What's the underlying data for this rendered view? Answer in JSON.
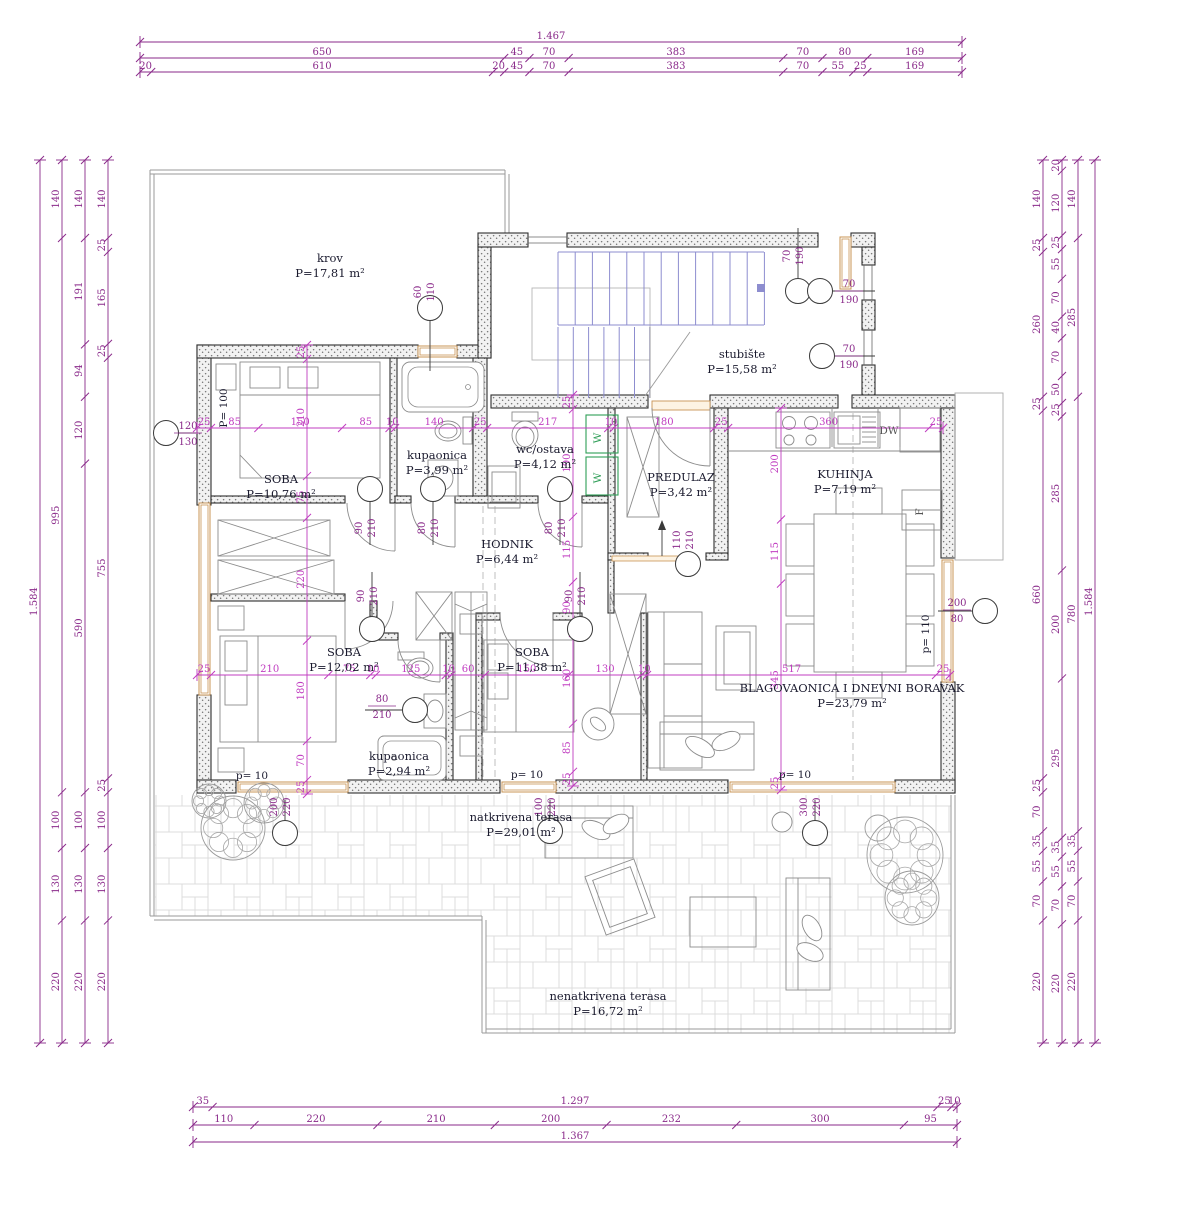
{
  "colors": {
    "dim": "#8a2a8a",
    "centerline": "#c03cc0",
    "wall_edge": "#2e2e2e",
    "marker_line": "#3a3a3a",
    "furniture": "#8c8c8c",
    "stairs": "#8d8dcf",
    "window_frame": "#c89455",
    "appliance_green": "#2f9e57",
    "room_text": "#1a1a2e",
    "outline": "#9a9a9a"
  },
  "rooms": [
    {
      "name": "krov",
      "area": "P=17,81 m²",
      "x": 330,
      "y": 262
    },
    {
      "name": "stubište",
      "area": "P=15,58 m²",
      "x": 742,
      "y": 358
    },
    {
      "name": "kupaonica",
      "area": "P=3,99 m²",
      "x": 437,
      "y": 459
    },
    {
      "name": "wc/ostava",
      "area": "P=4,12 m²",
      "x": 545,
      "y": 453
    },
    {
      "name": "PREDULAZ",
      "area": "P=3,42 m²",
      "x": 681,
      "y": 481
    },
    {
      "name": "KUHINJA",
      "area": "P=7,19 m²",
      "x": 845,
      "y": 478
    },
    {
      "name": "SOBA",
      "area": "P=10,76 m²",
      "x": 281,
      "y": 483
    },
    {
      "name": "HODNIK",
      "area": "P=6,44 m²",
      "x": 507,
      "y": 548
    },
    {
      "name": "SOBA",
      "area": "P=12,02 m²",
      "x": 344,
      "y": 656
    },
    {
      "name": "SOBA",
      "area": "P=11,38 m²",
      "x": 532,
      "y": 656
    },
    {
      "name": "BLAGOVAONICA I DNEVNI BORAVAK",
      "area": "P=23,79 m²",
      "x": 852,
      "y": 692
    },
    {
      "name": "kupaonica",
      "area": "P=2,94 m²",
      "x": 399,
      "y": 760
    },
    {
      "name": "natkrivena terasa",
      "area": "P=29,01 m²",
      "x": 521,
      "y": 821
    },
    {
      "name": "nenatkrivena terasa",
      "area": "P=16,72 m²",
      "x": 608,
      "y": 1000
    }
  ],
  "dim_chains": [
    {
      "id": "top-total",
      "orient": "h",
      "pos": 42,
      "from": 140,
      "to": 962,
      "values": [
        "1.467"
      ]
    },
    {
      "id": "top-2",
      "orient": "h",
      "pos": 58,
      "from": 140,
      "to": 962,
      "values": [
        "650",
        "45",
        "70",
        "383",
        "70",
        "80",
        "169"
      ]
    },
    {
      "id": "top-3",
      "orient": "h",
      "pos": 72,
      "from": 140,
      "to": 962,
      "values": [
        "20",
        "610",
        "20",
        "45",
        "70",
        "383",
        "70",
        "55",
        "25",
        "169"
      ]
    },
    {
      "id": "bottom-1",
      "orient": "h",
      "pos": 1107,
      "from": 193,
      "to": 957,
      "values": [
        "35",
        "1.297",
        "25",
        "10"
      ]
    },
    {
      "id": "bottom-2",
      "orient": "h",
      "pos": 1125,
      "from": 193,
      "to": 957,
      "values": [
        "110",
        "220",
        "210",
        "200",
        "232",
        "300",
        "95"
      ]
    },
    {
      "id": "bottom-total",
      "orient": "h",
      "pos": 1142,
      "from": 193,
      "to": 957,
      "values": [
        "1.367"
      ]
    },
    {
      "id": "left-total",
      "orient": "v",
      "pos": 40,
      "from": 160,
      "to": 1043,
      "values": [
        "1.584"
      ]
    },
    {
      "id": "left-2",
      "orient": "v",
      "pos": 62,
      "from": 160,
      "to": 1043,
      "values": [
        "140",
        "995",
        "100",
        "130",
        "220"
      ]
    },
    {
      "id": "left-3",
      "orient": "v",
      "pos": 85,
      "from": 160,
      "to": 1043,
      "values": [
        "140",
        "191",
        "94",
        "120",
        "590",
        "100",
        "130",
        "220"
      ]
    },
    {
      "id": "left-4",
      "orient": "v",
      "pos": 108,
      "from": 160,
      "to": 1043,
      "values": [
        "140",
        "25",
        "165",
        "25",
        "755",
        "25",
        "100",
        "130",
        "220"
      ]
    },
    {
      "id": "right-1",
      "orient": "v",
      "pos": 1043,
      "from": 160,
      "to": 1043,
      "values": [
        "140",
        "25",
        "260",
        "25",
        "660",
        "25",
        "70",
        "35",
        "55",
        "70",
        "220"
      ]
    },
    {
      "id": "right-2",
      "orient": "v",
      "pos": 1062,
      "from": 160,
      "to": 1043,
      "values": [
        "20",
        "120",
        "25",
        "55",
        "70",
        "40",
        "70",
        "50",
        "25",
        "285",
        "200",
        "295",
        "35",
        "55",
        "70",
        "220"
      ]
    },
    {
      "id": "right-3",
      "orient": "v",
      "pos": 1078,
      "from": 160,
      "to": 1043,
      "values": [
        "140",
        "285",
        "780",
        "35",
        "55",
        "70",
        "220"
      ]
    },
    {
      "id": "right-total",
      "orient": "v",
      "pos": 1095,
      "from": 160,
      "to": 1043,
      "values": [
        "1.584"
      ]
    },
    {
      "id": "int-h1",
      "orient": "h",
      "pos": 428,
      "from": 197,
      "to": 943,
      "color": "centerline",
      "values": [
        "25",
        "85",
        "150",
        "85",
        "10",
        "140",
        "25",
        "217",
        "10",
        "180",
        "25",
        "360",
        "25"
      ]
    },
    {
      "id": "int-h2",
      "orient": "h",
      "pos": 675,
      "from": 197,
      "to": 950,
      "color": "centerline",
      "values": [
        "25",
        "210",
        "75",
        "10",
        "125",
        "10",
        "60",
        "150",
        "130",
        "10",
        "517",
        "25"
      ]
    },
    {
      "id": "int-v1",
      "orient": "v",
      "pos": 307,
      "from": 345,
      "to": 794,
      "color": "centerline",
      "values": [
        "25",
        "210",
        "75",
        "220",
        "180",
        "70",
        "25"
      ]
    },
    {
      "id": "int-v2",
      "orient": "v",
      "pos": 573,
      "from": 395,
      "to": 786,
      "color": "centerline",
      "values": [
        "25",
        "190",
        "115",
        "90",
        "160",
        "85",
        "25"
      ]
    },
    {
      "id": "int-v3",
      "orient": "v",
      "pos": 781,
      "from": 408,
      "to": 790,
      "color": "centerline",
      "values": [
        "200",
        "115",
        "345",
        "25"
      ]
    }
  ],
  "markers": [
    {
      "name": "krov-window",
      "mode": "rot",
      "labels": [
        "60",
        "110"
      ],
      "circle": [
        430,
        308
      ],
      "line": [
        430,
        321,
        430,
        371
      ],
      "lx": 421,
      "ly": 292
    },
    {
      "name": "left-window",
      "mode": "frac",
      "labels": [
        "120",
        "130"
      ],
      "circle": [
        166,
        433
      ],
      "line": [
        179,
        433,
        196,
        433
      ],
      "lx": 188,
      "ly": 429
    },
    {
      "name": "door-soba1",
      "mode": "rot",
      "labels": [
        "90",
        "210"
      ],
      "circle": [
        370,
        489
      ],
      "line": [
        370,
        502,
        370,
        545
      ],
      "lx": 362,
      "ly": 528
    },
    {
      "name": "door-kupaonica",
      "mode": "rot",
      "labels": [
        "80",
        "210"
      ],
      "circle": [
        433,
        489
      ],
      "line": [
        433,
        502,
        433,
        545
      ],
      "lx": 425,
      "ly": 528
    },
    {
      "name": "door-wc",
      "mode": "rot",
      "labels": [
        "80",
        "210"
      ],
      "circle": [
        560,
        489
      ],
      "line": [
        560,
        502,
        560,
        545
      ],
      "lx": 552,
      "ly": 528
    },
    {
      "name": "door-soba2",
      "mode": "rot",
      "labels": [
        "90",
        "210"
      ],
      "circle": [
        372,
        629
      ],
      "line": [
        372,
        572,
        372,
        616
      ],
      "lx": 364,
      "ly": 596
    },
    {
      "name": "door-soba3",
      "mode": "rot",
      "labels": [
        "90",
        "210"
      ],
      "circle": [
        580,
        629
      ],
      "line": [
        580,
        572,
        580,
        616
      ],
      "lx": 572,
      "ly": 596
    },
    {
      "name": "door-kup2",
      "mode": "frac",
      "labels": [
        "80",
        "210"
      ],
      "circle": [
        415,
        710
      ],
      "line": [
        365,
        710,
        402,
        710
      ],
      "lx": 382,
      "ly": 702
    },
    {
      "name": "stair-win-top",
      "mode": "rot",
      "labels": [
        "70",
        "190"
      ],
      "circle": [
        798,
        291
      ],
      "line": [
        798,
        228,
        798,
        278
      ],
      "lx": 790,
      "ly": 256
    },
    {
      "name": "stair-win-1",
      "mode": "frac",
      "labels": [
        "70",
        "190"
      ],
      "circle": [
        820,
        291
      ],
      "line": [
        833,
        291,
        875,
        291
      ],
      "lx": 849,
      "ly": 287
    },
    {
      "name": "stair-win-2",
      "mode": "frac",
      "labels": [
        "70",
        "190"
      ],
      "circle": [
        822,
        356
      ],
      "line": [
        835,
        356,
        875,
        356
      ],
      "lx": 849,
      "ly": 352
    },
    {
      "name": "kitchen-window",
      "mode": "frac",
      "labels": [
        "200",
        "80"
      ],
      "circle": [
        985,
        611
      ],
      "line": [
        938,
        611,
        972,
        611
      ],
      "lx": 957,
      "ly": 606
    },
    {
      "name": "terrace-win-1",
      "mode": "rot",
      "labels": [
        "200",
        "220"
      ],
      "circle": [
        285,
        833
      ],
      "line": [
        285,
        800,
        285,
        820
      ],
      "lx": 277,
      "ly": 807
    },
    {
      "name": "terrace-win-2",
      "mode": "rot",
      "labels": [
        "100",
        "220"
      ],
      "circle": [
        550,
        831
      ],
      "line": [
        550,
        800,
        550,
        818
      ],
      "lx": 542,
      "ly": 807
    },
    {
      "name": "terrace-win-3",
      "mode": "rot",
      "labels": [
        "300",
        "220"
      ],
      "circle": [
        815,
        833
      ],
      "line": [
        815,
        800,
        815,
        820
      ],
      "lx": 807,
      "ly": 807
    },
    {
      "name": "entrance",
      "mode": "rot",
      "labels": [
        "110",
        "210"
      ],
      "circle": [
        688,
        564
      ],
      "line": [
        662,
        556,
        662,
        526
      ],
      "arrow": true,
      "lx": 680,
      "ly": 540
    }
  ],
  "annotations": [
    {
      "text": "p= 10",
      "x": 252,
      "y": 779
    },
    {
      "text": "p= 10",
      "x": 527,
      "y": 778
    },
    {
      "text": "p= 10",
      "x": 795,
      "y": 778
    },
    {
      "text": "P= 100",
      "x": 227,
      "y": 408,
      "rot": true
    },
    {
      "text": "p= 110",
      "x": 929,
      "y": 634,
      "rot": true
    }
  ],
  "appliances": [
    {
      "text": "DW",
      "x": 889,
      "y": 434
    },
    {
      "text": "F",
      "x": 923,
      "y": 512,
      "rot": true
    },
    {
      "text": "W",
      "x": 601,
      "y": 438,
      "rot": true,
      "green": true
    },
    {
      "text": "W",
      "x": 601,
      "y": 478,
      "rot": true,
      "green": true
    }
  ]
}
